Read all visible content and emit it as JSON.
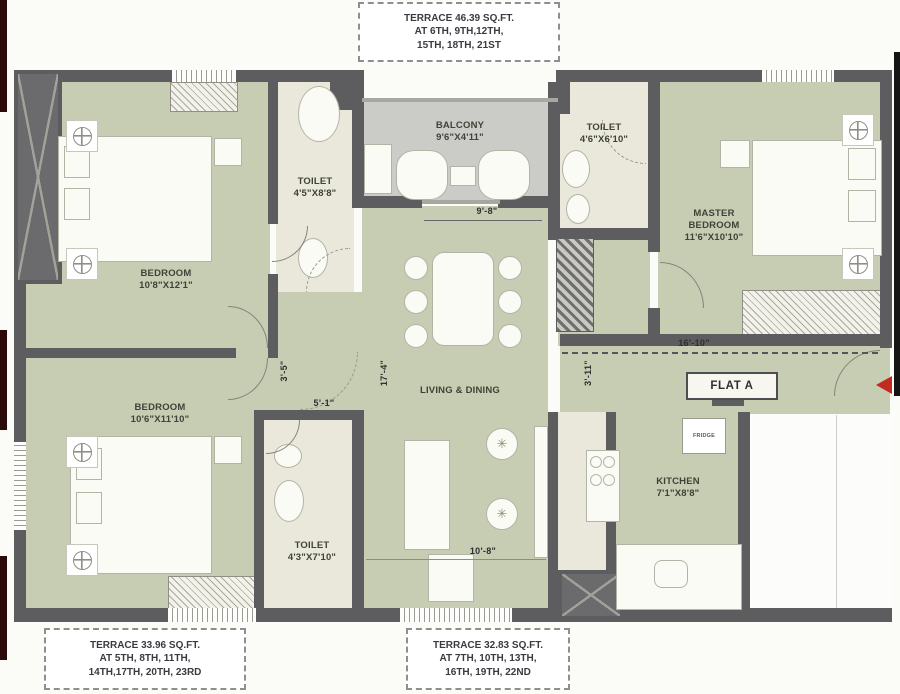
{
  "colors": {
    "wall": "#5d5d5f",
    "room_green": "#c6cdb2",
    "toilet_cream": "#e9e8da",
    "balcony_gray": "#cbcbc8",
    "edge_maroon": "#2d0a0a",
    "edge_black": "#151515",
    "entrance_arrow_red": "#c22a22"
  },
  "terrace_notes": {
    "top": [
      "TERRACE 46.39 SQ.FT.",
      "AT 6TH, 9TH,12TH,",
      "15TH, 18TH, 21ST"
    ],
    "bottom_left": [
      "TERRACE 33.96 SQ.FT.",
      "AT 5TH, 8TH, 11TH,",
      "14TH,17TH, 20TH, 23RD"
    ],
    "bottom_right": [
      "TERRACE 32.83 SQ.FT.",
      "AT 7TH, 10TH, 13TH,",
      "16TH, 19TH, 22ND"
    ]
  },
  "rooms": {
    "bedroom_top": {
      "name": "BEDROOM",
      "size": "10'8\"X12'1\""
    },
    "bedroom_bottom": {
      "name": "BEDROOM",
      "size": "10'6\"X11'10\""
    },
    "master_bedroom": {
      "name": "MASTER BEDROOM",
      "size": "11'6\"X10'10\""
    },
    "toilet_top_left": {
      "name": "TOILET",
      "size": "4'5\"X8'8\""
    },
    "toilet_top_right": {
      "name": "TOILET",
      "size": "4'6\"X6'10\""
    },
    "toilet_bottom": {
      "name": "TOILET",
      "size": "4'3\"X7'10\""
    },
    "balcony": {
      "name": "BALCONY",
      "size": "9'6\"X4'11\""
    },
    "living": {
      "name": "LIVING & DINING"
    },
    "kitchen": {
      "name": "KITCHEN",
      "size": "7'1\"X8'8\""
    }
  },
  "labels": {
    "flat": "FLAT A",
    "fridge": "FRIDGE"
  },
  "dims": {
    "balcony_front": "9'-8\"",
    "entry_width": "16'-10\"",
    "lobby_width": "5'-1\"",
    "living_depth": "17'-4\"",
    "passage_a": "3'-5\"",
    "passage_b": "3'-11\"",
    "living_width": "10'-8\""
  }
}
